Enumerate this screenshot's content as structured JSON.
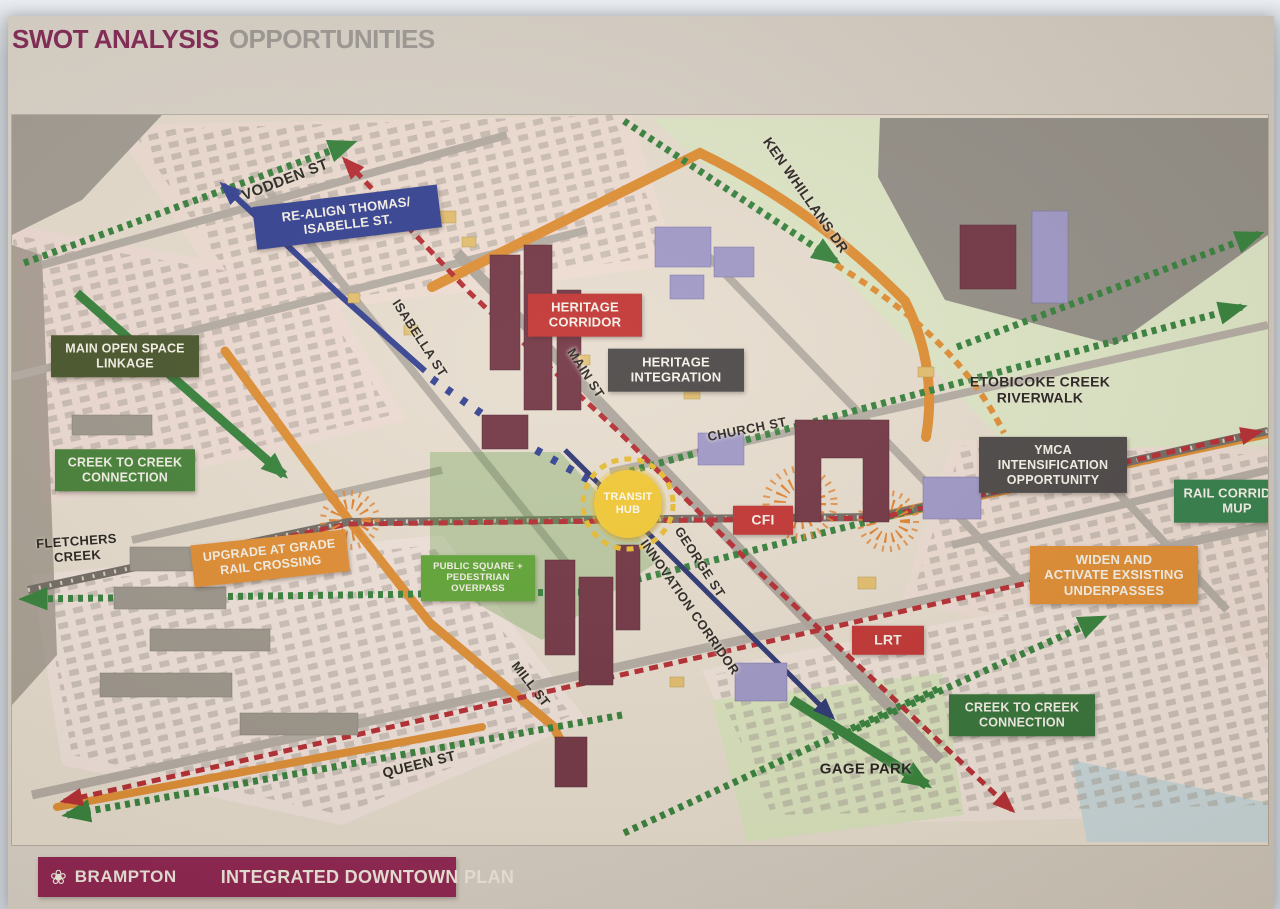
{
  "poster": {
    "title": {
      "primary": "SWOT ANALYSIS",
      "secondary": "OPPORTUNITIES"
    },
    "footer": {
      "logo": "brampton-flower-logo",
      "brand": "BRAMPTON",
      "plan_title": "INTEGRATED DOWNTOWN PLAN"
    }
  },
  "palette": {
    "blue": "#2c3a8d",
    "red": "#c02d2b",
    "orange": "#e0892a",
    "gray": "#454140",
    "dark_green": "#414f23",
    "green": "#3f7d31",
    "bright_green": "#5aa22f",
    "forest_green": "#2e6e31",
    "rail_green": "#2c7b44",
    "yellow": "#f2c72e",
    "title_maroon": "#7e2150",
    "title_gray": "#9b9691",
    "footer_maroon": "#8c1c4b"
  },
  "map": {
    "street_labels": [
      {
        "id": "vodden-st",
        "text": "VODDEN ST",
        "x": 273,
        "y": 65,
        "rot": -21,
        "size": 15
      },
      {
        "id": "ken-whillans-dr",
        "text": "KEN WHILLANS DR",
        "x": 794,
        "y": 80,
        "rot": 55,
        "size": 14
      },
      {
        "id": "isabella-st",
        "text": "ISABELLA ST",
        "x": 408,
        "y": 223,
        "rot": 57,
        "size": 13
      },
      {
        "id": "main-st",
        "text": "MAIN ST",
        "x": 574,
        "y": 258,
        "rot": 57,
        "size": 13
      },
      {
        "id": "church-st",
        "text": "CHURCH ST",
        "x": 735,
        "y": 314,
        "rot": -11,
        "size": 13
      },
      {
        "id": "george-st",
        "text": "GEORGE ST",
        "x": 688,
        "y": 447,
        "rot": 57,
        "size": 13
      },
      {
        "id": "innovation-corridor",
        "text": "INNOVATION CORRIDOR",
        "x": 678,
        "y": 492,
        "rot": 55,
        "size": 13
      },
      {
        "id": "mill-st",
        "text": "MILL ST",
        "x": 519,
        "y": 569,
        "rot": 52,
        "size": 13
      },
      {
        "id": "queen-st",
        "text": "QUEEN ST",
        "x": 407,
        "y": 649,
        "rot": -14,
        "size": 14
      }
    ],
    "area_labels": [
      {
        "id": "fletchers-creek",
        "lines": [
          "FLETCHERS",
          "CREEK"
        ],
        "x": 65,
        "y": 434,
        "rot": -4,
        "size": 13
      },
      {
        "id": "etobicoke-creek-riverwalk",
        "lines": [
          "ETOBICOKE CREEK",
          "RIVERWALK"
        ],
        "x": 1028,
        "y": 275,
        "rot": 0,
        "size": 14
      },
      {
        "id": "gage-park",
        "lines": [
          "GAGE PARK"
        ],
        "x": 854,
        "y": 655,
        "rot": 0,
        "size": 15
      }
    ],
    "callouts": [
      {
        "id": "realign-thomas-isabelle",
        "type": "blue",
        "lines": [
          "RE-ALIGN THOMAS/",
          "ISABELLE ST."
        ],
        "x": 335,
        "y": 102,
        "w": 172,
        "rot": -7,
        "size": 13
      },
      {
        "id": "heritage-corridor",
        "type": "red",
        "lines": [
          "HERITAGE",
          "CORRIDOR"
        ],
        "x": 573,
        "y": 200,
        "w": 100,
        "rot": 0,
        "size": 13
      },
      {
        "id": "heritage-integration",
        "type": "gray",
        "lines": [
          "HERITAGE",
          "INTEGRATION"
        ],
        "x": 664,
        "y": 255,
        "w": 122,
        "rot": 0,
        "size": 13
      },
      {
        "id": "main-open-space-linkage",
        "type": "dark_green",
        "lines": [
          "MAIN OPEN SPACE",
          "LINKAGE"
        ],
        "x": 113,
        "y": 241,
        "w": 134,
        "rot": 0,
        "size": 12.5
      },
      {
        "id": "creek-to-creek-connection-west",
        "type": "green",
        "lines": [
          "CREEK TO CREEK",
          "CONNECTION"
        ],
        "x": 113,
        "y": 355,
        "w": 126,
        "rot": 0,
        "size": 12.5
      },
      {
        "id": "upgrade-at-grade-rail-crossing",
        "type": "orange",
        "lines": [
          "UPGRADE AT GRADE",
          "RAIL CROSSING"
        ],
        "x": 258,
        "y": 443,
        "w": 142,
        "rot": -6,
        "size": 12.5
      },
      {
        "id": "public-square-pedestrian-overpass",
        "type": "bright_green",
        "lines": [
          "PUBLIC SQUARE +",
          "PEDESTRIAN",
          "OVERPASS"
        ],
        "x": 466,
        "y": 463,
        "w": 100,
        "rot": 0,
        "size": 9.5
      },
      {
        "id": "transit-hub",
        "type": "yellow",
        "lines": [
          "TRANSIT",
          "HUB"
        ],
        "x": 616,
        "y": 389,
        "w": 68,
        "rot": 0,
        "size": 11
      },
      {
        "id": "cfi",
        "type": "red",
        "lines": [
          "CFI"
        ],
        "x": 751,
        "y": 405,
        "w": 46,
        "rot": 0,
        "size": 14
      },
      {
        "id": "ymca-intensification-opportunity",
        "type": "gray",
        "lines": [
          "YMCA",
          "INTENSIFICATION",
          "OPPORTUNITY"
        ],
        "x": 1041,
        "y": 350,
        "w": 134,
        "rot": 0,
        "size": 12.5
      },
      {
        "id": "rail-corridor-mup",
        "type": "rail_green",
        "lines": [
          "RAIL CORRIDOR",
          "MUP"
        ],
        "x": 1225,
        "y": 386,
        "w": 112,
        "rot": 0,
        "size": 13
      },
      {
        "id": "widen-activate-underpasses",
        "type": "orange",
        "lines": [
          "WIDEN AND",
          "ACTIVATE EXSISTING",
          "UNDERPASSES"
        ],
        "x": 1102,
        "y": 460,
        "w": 154,
        "rot": 0,
        "size": 13
      },
      {
        "id": "lrt",
        "type": "red",
        "lines": [
          "LRT"
        ],
        "x": 876,
        "y": 525,
        "w": 58,
        "rot": 0,
        "size": 14
      },
      {
        "id": "creek-to-creek-connection-east",
        "type": "forest_green",
        "lines": [
          "CREEK TO CREEK",
          "CONNECTION"
        ],
        "x": 1010,
        "y": 600,
        "w": 132,
        "rot": 0,
        "size": 12.5
      }
    ]
  }
}
